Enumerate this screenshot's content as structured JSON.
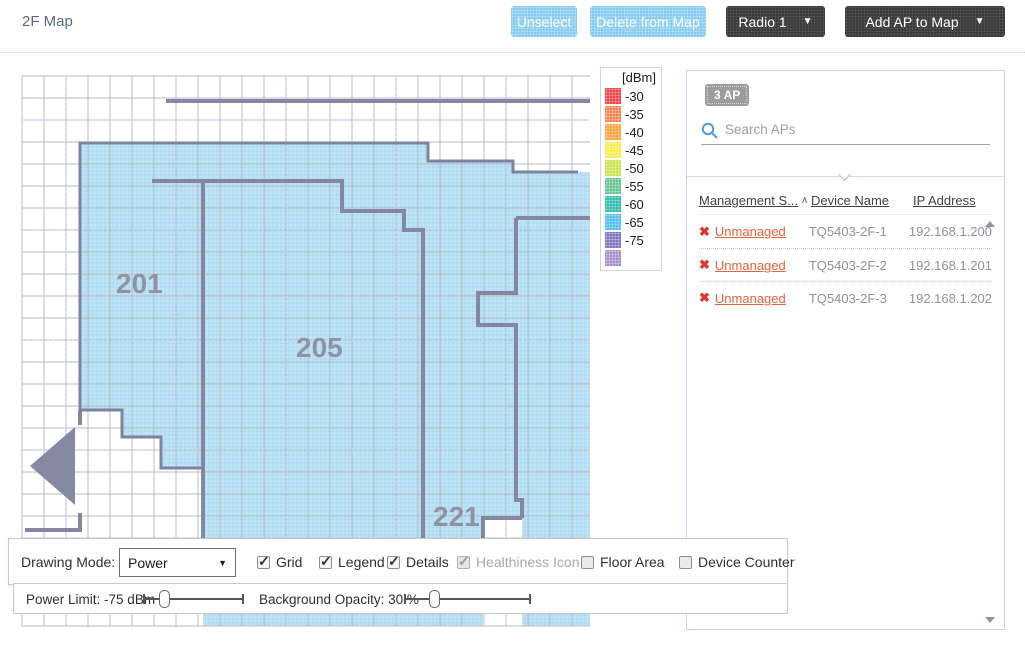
{
  "page": {
    "title": "2F Map"
  },
  "icons": {
    "caret": "▼",
    "unmanaged_x": "✖"
  },
  "toolbar": {
    "unselect": "Unselect",
    "delete_from_map": "Delete from Map",
    "radio_select": "Radio 1",
    "add_ap": "Add AP to Map"
  },
  "legend": {
    "title": "[dBm]",
    "items": [
      {
        "label": "-30",
        "color": "#f2434b"
      },
      {
        "label": "-35",
        "color": "#f8824f"
      },
      {
        "label": "-40",
        "color": "#fba33b"
      },
      {
        "label": "-45",
        "color": "#f8ec48"
      },
      {
        "label": "-50",
        "color": "#cbe14e"
      },
      {
        "label": "-55",
        "color": "#67c493"
      },
      {
        "label": "-60",
        "color": "#2fbcab"
      },
      {
        "label": "-65",
        "color": "#53bdf0"
      },
      {
        "label": "-75",
        "color": "#8172c2"
      },
      {
        "label": "",
        "color": "#a78fcd"
      }
    ]
  },
  "map": {
    "rooms": [
      "201",
      "205",
      "221"
    ]
  },
  "ap_panel": {
    "count_badge": "3 AP",
    "search_placeholder": "Search APs",
    "columns": [
      "Management S...",
      "Device Name",
      "IP Address"
    ],
    "sort_indicator": "∧",
    "rows": [
      {
        "status": "Unmanaged",
        "device_name": "TQ5403-2F-1",
        "ip": "192.168.1.200"
      },
      {
        "status": "Unmanaged",
        "device_name": "TQ5403-2F-2",
        "ip": "192.168.1.201"
      },
      {
        "status": "Unmanaged",
        "device_name": "TQ5403-2F-3",
        "ip": "192.168.1.202"
      }
    ]
  },
  "controls": {
    "drawing_mode_label": "Drawing Mode:",
    "drawing_mode_value": "Power",
    "checkboxes": [
      {
        "label": "Grid",
        "checked": true,
        "disabled": false
      },
      {
        "label": "Legend",
        "checked": true,
        "disabled": false
      },
      {
        "label": "Details",
        "checked": true,
        "disabled": false
      },
      {
        "label": "Healthiness Icon",
        "checked": true,
        "disabled": true
      },
      {
        "label": "Floor Area",
        "checked": false,
        "disabled": false
      },
      {
        "label": "Device Counter",
        "checked": false,
        "disabled": false
      }
    ],
    "power_limit_label": "Power Limit:",
    "power_limit_value": "-75 dBm",
    "opacity_label": "Background Opacity:",
    "opacity_value": "30 %"
  }
}
